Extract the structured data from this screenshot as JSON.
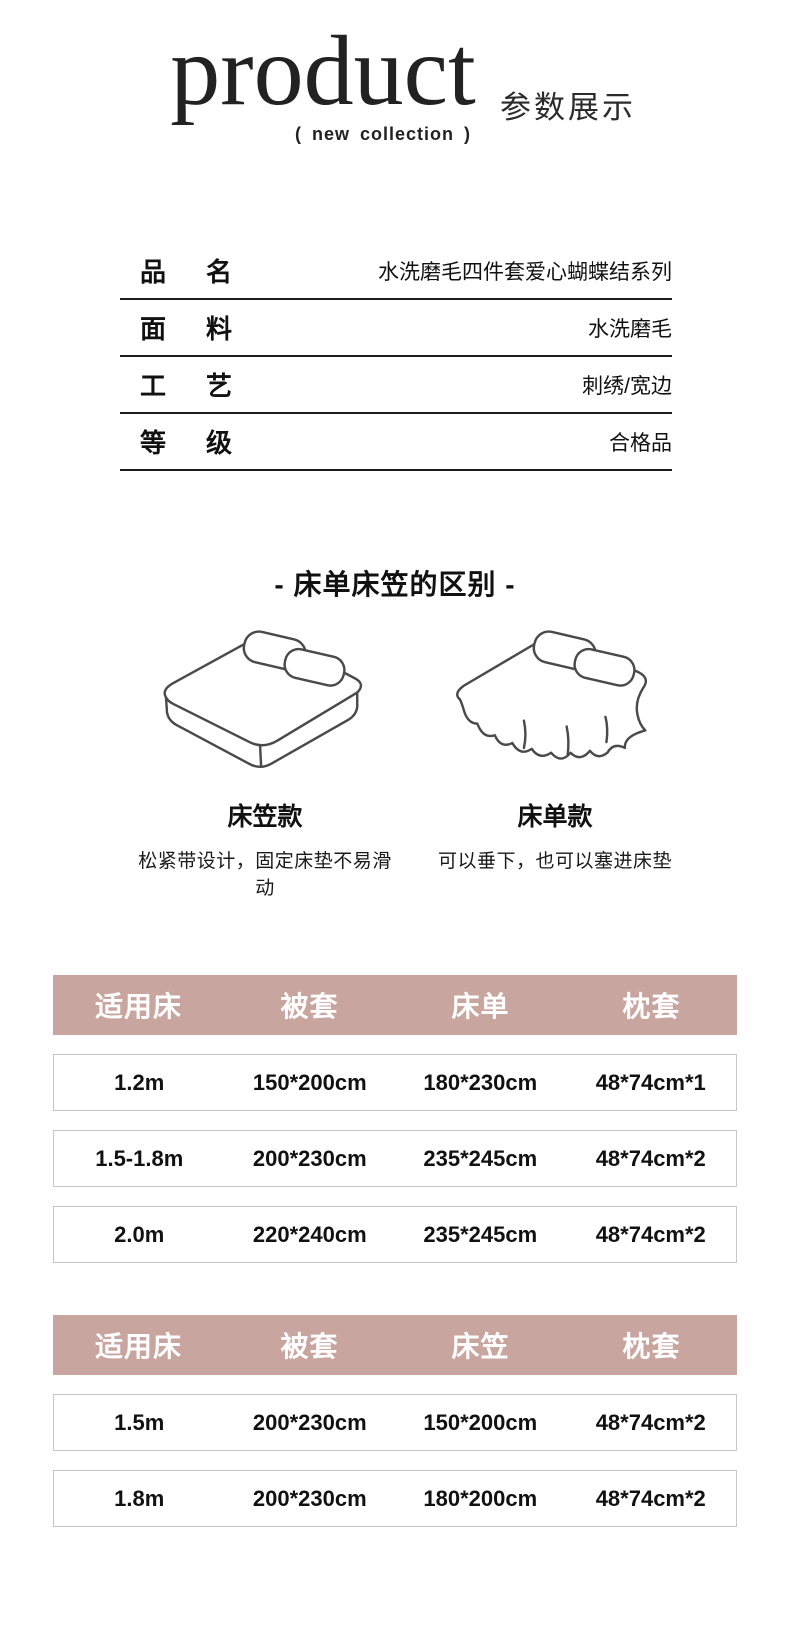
{
  "header": {
    "title": "product",
    "subtitle": "(  new collection  )",
    "side_label": "参数展示"
  },
  "specs": [
    {
      "chars": [
        "品",
        "名"
      ],
      "value": "水洗磨毛四件套爱心蝴蝶结系列"
    },
    {
      "chars": [
        "面",
        "料"
      ],
      "value": "水洗磨毛"
    },
    {
      "chars": [
        "工",
        "艺"
      ],
      "value": "刺绣/宽边"
    },
    {
      "chars": [
        "等",
        "级"
      ],
      "value": "合格品"
    }
  ],
  "difference": {
    "heading": "- 床单床笠的区别 -",
    "items": [
      {
        "name": "床笠款",
        "desc": "松紧带设计，固定床垫不易滑动",
        "icon": "fitted-sheet-bed-icon"
      },
      {
        "name": "床单款",
        "desc": "可以垂下，也可以塞进床垫",
        "icon": "flat-sheet-bed-icon"
      }
    ]
  },
  "size_tables": [
    {
      "headers": [
        "适用床",
        "被套",
        "床单",
        "枕套"
      ],
      "rows": [
        [
          "1.2m",
          "150*200cm",
          "180*230cm",
          "48*74cm*1"
        ],
        [
          "1.5-1.8m",
          "200*230cm",
          "235*245cm",
          "48*74cm*2"
        ],
        [
          "2.0m",
          "220*240cm",
          "235*245cm",
          "48*74cm*2"
        ]
      ]
    },
    {
      "headers": [
        "适用床",
        "被套",
        "床笠",
        "枕套"
      ],
      "rows": [
        [
          "1.5m",
          "200*230cm",
          "150*200cm",
          "48*74cm*2"
        ],
        [
          "1.8m",
          "200*230cm",
          "180*200cm",
          "48*74cm*2"
        ]
      ]
    }
  ],
  "colors": {
    "table_header_bg": "#c9a5a0",
    "table_header_text": "#ffffff",
    "row_border": "#c6c6c6",
    "text": "#141414",
    "line_art": "#4a4a4a"
  }
}
